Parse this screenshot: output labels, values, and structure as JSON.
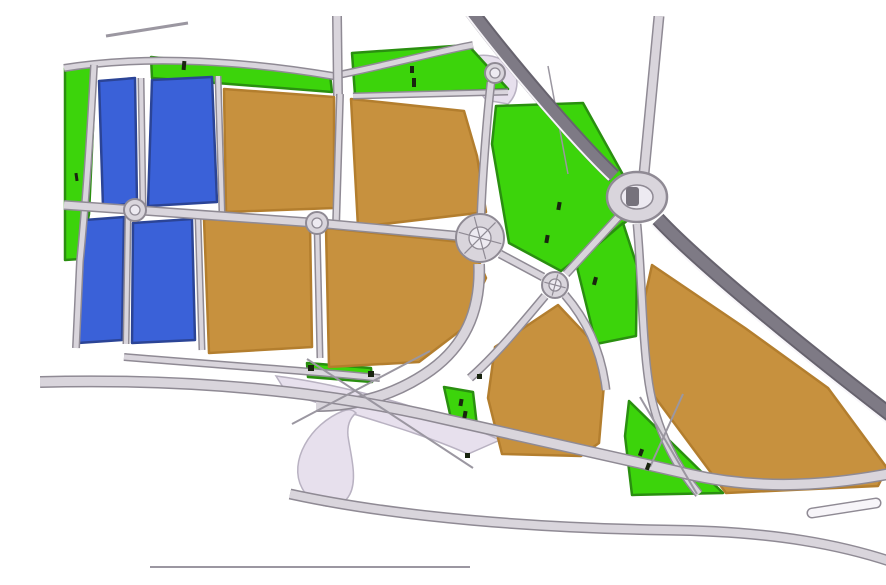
{
  "map": {
    "width": 886,
    "height": 553,
    "background": "#ffffff",
    "palette": {
      "road_fill": "#d9d5dc",
      "road_casing": "#8f8a94",
      "road_thin": "#9b97a1",
      "highway_fill": "#7e7a85",
      "highway_casing": "#67636e",
      "zone_fill": "#e7e0ed",
      "zone_edge": "#b9b2c2",
      "green_fill": "#3cd40b",
      "green_edge": "#2a8f10",
      "blue_fill": "#3a61d8",
      "blue_edge": "#2b4496",
      "tan_fill": "#c7913e",
      "tan_edge": "#b37e2e",
      "island_fill": "#edeaf1",
      "mark": "#19240f",
      "white_line": "#f7f5f9"
    },
    "zones": [
      {
        "name": "interchange-zone",
        "d": "M236,360 C300,368 390,392 460,424 L428,438 C370,412 300,396 246,376 Z"
      },
      {
        "name": "loop-ramp-teardrop",
        "d": "M303,395 C270,408 248,446 262,472 C272,492 300,498 310,478 C318,462 310,436 308,420 C307,410 310,402 316,397 C312,393 308,393 303,395 Z"
      },
      {
        "name": "north-interchange-zone",
        "d": "M430,42 C444,36 462,40 472,52 C480,62 478,78 468,88 L446,84 C436,72 430,56 430,42 Z"
      }
    ],
    "parcels": [
      {
        "name": "green-strip-west",
        "type": "green",
        "d": "M25,52 L56,47 L49,198 L40,243 L25,244 Z"
      },
      {
        "name": "green-strip-north-small",
        "type": "green",
        "d": "M111,41 L290,59 L292,76 L112,62 Z"
      },
      {
        "name": "green-strip-north-large",
        "type": "green",
        "d": "M312,37 L428,29 L468,73 L315,79 Z"
      },
      {
        "name": "green-parcel-central-north",
        "type": "green",
        "d": "M456,90 L543,87 L587,166 L592,201 L521,255 L469,227 L452,128 Z"
      },
      {
        "name": "green-parcel-central-east",
        "type": "green",
        "d": "M536,247 L583,207 L597,250 L596,320 L556,328 Z"
      },
      {
        "name": "green-strip-south-small",
        "type": "green",
        "d": "M267,347 L331,352 L332,366 L268,361 Z"
      },
      {
        "name": "green-strip-mid-small",
        "type": "green",
        "d": "M404,371 L433,376 L437,410 L412,407 Z"
      },
      {
        "name": "green-triangle-south",
        "type": "green",
        "d": "M589,385 L683,477 L592,479 L585,420 Z"
      },
      {
        "name": "green-triangle-corner",
        "type": "green",
        "d": "M848,492 L886,455 L886,494 Z"
      },
      {
        "name": "blue-parcel-nw",
        "type": "blue",
        "d": "M59,65 L95,62 L97,187 L63,191 Z"
      },
      {
        "name": "blue-parcel-north",
        "type": "blue",
        "d": "M112,64 L172,61 L177,186 L108,190 Z"
      },
      {
        "name": "blue-parcel-sw",
        "type": "blue",
        "d": "M45,204 L84,201 L82,324 L38,327 Z"
      },
      {
        "name": "blue-parcel-south",
        "type": "blue",
        "d": "M93,207 L152,203 L155,324 L92,327 Z"
      },
      {
        "name": "tan-parcel-a",
        "type": "tan",
        "d": "M184,73 L294,81 L294,192 L186,196 Z"
      },
      {
        "name": "tan-parcel-b",
        "type": "tan",
        "d": "M311,83 L424,95 L437,140 L446,196 L318,211 Z"
      },
      {
        "name": "tan-parcel-c",
        "type": "tan",
        "d": "M164,203 L270,209 L272,331 L169,337 Z"
      },
      {
        "name": "tan-parcel-d",
        "type": "tan",
        "d": "M286,212 L431,227 L446,262 L421,314 L379,346 L289,351 Z"
      },
      {
        "name": "tan-parcel-e",
        "type": "tan",
        "d": "M455,331 L518,289 L551,324 L564,368 L559,427 L541,440 L462,438 L448,382 Z"
      },
      {
        "name": "tan-parcel-f",
        "type": "tan",
        "d": "M612,249 L705,312 L788,372 L847,452 L838,470 L686,477 L609,373 L601,299 Z"
      }
    ],
    "roads": [
      {
        "name": "top-left-road-stub",
        "kind": "thin",
        "d": "M66,20 L148,7",
        "w": 3
      },
      {
        "name": "north-boundary-road",
        "kind": "local",
        "d": "M24,52 C110,38 210,46 293,60 C345,50 400,35 433,29",
        "w": 5
      },
      {
        "name": "green-strip-south-road",
        "kind": "local",
        "d": "M313,80 L468,76",
        "w": 4
      },
      {
        "name": "north-vertical-road",
        "kind": "local",
        "d": "M297,0 L298,80",
        "w": 7
      },
      {
        "name": "west-vertical-road",
        "kind": "local",
        "d": "M54,49 C49,140 44,205 40,245 L36,332",
        "w": 5
      },
      {
        "name": "blue-column-road-upper",
        "kind": "local",
        "d": "M101,62 L103,191",
        "w": 4
      },
      {
        "name": "blue-column-road-lower",
        "kind": "local",
        "d": "M88,200 L86,328",
        "w": 4
      },
      {
        "name": "blue-tan-divider-upper",
        "kind": "local",
        "d": "M178,60 L182,196",
        "w": 4
      },
      {
        "name": "blue-tan-divider-lower",
        "kind": "local",
        "d": "M158,201 L162,334",
        "w": 4
      },
      {
        "name": "tan-divider-vertical",
        "kind": "local",
        "d": "M300,78 L296,211",
        "w": 5
      },
      {
        "name": "tan-column-road",
        "kind": "local",
        "d": "M277,207 L280,342",
        "w": 4
      },
      {
        "name": "mid-horizontal-avenue",
        "kind": "local",
        "d": "M24,189 L95,194 L277,207 L440,222",
        "w": 7
      },
      {
        "name": "south-boundary-road",
        "kind": "local",
        "d": "M84,341 C180,349 270,355 340,362",
        "w": 5
      },
      {
        "name": "interchange-vertical-link",
        "kind": "local",
        "d": "M451,66 C446,110 442,170 441,198",
        "w": 6
      },
      {
        "name": "main-curve-from-center",
        "kind": "local",
        "d": "M439,248 C441,296 424,330 391,354 C356,379 316,390 276,390",
        "w": 9
      },
      {
        "name": "center-to-small-roundabout",
        "kind": "local",
        "d": "M460,238 L503,261",
        "w": 6
      },
      {
        "name": "small-roundabout-to-ellipse",
        "kind": "local",
        "d": "M526,258 L582,197",
        "w": 6
      },
      {
        "name": "small-roundabout-southeast-road",
        "kind": "local",
        "d": "M525,279 C550,308 562,340 566,374",
        "w": 6
      },
      {
        "name": "small-roundabout-southwest-road",
        "kind": "local",
        "d": "M505,280 C480,310 455,340 430,362",
        "w": 6
      },
      {
        "name": "ellipse-south-road",
        "kind": "local",
        "d": "M597,208 C602,260 602,322 609,368 C616,414 637,452 659,478",
        "w": 6
      },
      {
        "name": "north-road-to-ellipse",
        "kind": "local",
        "d": "M619,0 L604,158",
        "w": 8
      },
      {
        "name": "southwest-sweep-boulevard",
        "kind": "local",
        "d": "M0,366 C150,362 280,376 382,398 C500,424 570,440 648,458 C730,477 810,468 886,450",
        "w": 9
      },
      {
        "name": "south-parallel-road",
        "kind": "local",
        "d": "M250,478 C360,502 500,512 624,514 C730,515 806,528 872,553",
        "w": 8
      },
      {
        "name": "bottom-edge-line",
        "kind": "thin",
        "d": "M110,551 L430,551",
        "w": 2
      },
      {
        "name": "ramp-line-a",
        "kind": "thin",
        "d": "M267,343 L433,452",
        "w": 2
      },
      {
        "name": "ramp-line-b",
        "kind": "thin",
        "d": "M390,335 L252,408",
        "w": 2
      },
      {
        "name": "green-triangle-line-a",
        "kind": "thin",
        "d": "M600,381 L657,478",
        "w": 2
      },
      {
        "name": "green-triangle-line-b",
        "kind": "thin",
        "d": "M643,378 L610,451",
        "w": 2
      },
      {
        "name": "green-parcel-boundary-line",
        "kind": "thin",
        "d": "M508,50 L528,158",
        "w": 1.5
      },
      {
        "name": "corner-green-line",
        "kind": "thin",
        "d": "M852,488 L882,458",
        "w": 1.5
      },
      {
        "name": "main-diagonal-highway-north",
        "kind": "highway",
        "d": "M429,-8 C468,44 538,126 574,160",
        "w": 11
      },
      {
        "name": "main-diagonal-highway-south",
        "kind": "highway",
        "d": "M618,203 C660,248 770,338 886,426",
        "w": 11
      },
      {
        "name": "highway-edge-line-south",
        "kind": "white",
        "d": "M612,209 C654,254 764,344 880,432",
        "w": 2
      },
      {
        "name": "highway-edge-line-north",
        "kind": "white",
        "d": "M424,-4 C463,48 533,130 569,164",
        "w": 2
      }
    ],
    "slots": [
      {
        "name": "median-island",
        "d": "M772,497 L836,487",
        "w": 8
      }
    ],
    "roundabouts": [
      {
        "name": "interchange-circle",
        "cx": 455,
        "cy": 57,
        "r": 10,
        "ri": 5
      },
      {
        "name": "roundabout-west",
        "cx": 95,
        "cy": 194,
        "r": 11,
        "ri": 5
      },
      {
        "name": "roundabout-midwest",
        "cx": 277,
        "cy": 207,
        "r": 11,
        "ri": 5
      },
      {
        "name": "roundabout-center",
        "cx": 440,
        "cy": 222,
        "r": 24,
        "ri": 11,
        "spokes": 3
      },
      {
        "name": "roundabout-small-east",
        "cx": 515,
        "cy": 269,
        "r": 13,
        "ri": 6,
        "spokes": 2
      },
      {
        "name": "roundabout-main-ellipse",
        "cx": 597,
        "cy": 181,
        "rx": 30,
        "ry": 25,
        "rix": 16,
        "riy": 12,
        "blob": true
      }
    ],
    "marks": [
      {
        "x": 35,
        "y": 157,
        "w": 3,
        "h": 8,
        "rot": -8
      },
      {
        "x": 142,
        "y": 45,
        "w": 4,
        "h": 9,
        "rot": 5
      },
      {
        "x": 370,
        "y": 50,
        "w": 4,
        "h": 7,
        "rot": 0
      },
      {
        "x": 372,
        "y": 62,
        "w": 4,
        "h": 9,
        "rot": 0
      },
      {
        "x": 517,
        "y": 186,
        "w": 4,
        "h": 8,
        "rot": 10
      },
      {
        "x": 505,
        "y": 219,
        "w": 4,
        "h": 8,
        "rot": 10
      },
      {
        "x": 553,
        "y": 261,
        "w": 4,
        "h": 8,
        "rot": 15
      },
      {
        "x": 599,
        "y": 433,
        "w": 4,
        "h": 7,
        "rot": 20
      },
      {
        "x": 606,
        "y": 447,
        "w": 4,
        "h": 7,
        "rot": 20
      },
      {
        "x": 419,
        "y": 383,
        "w": 4,
        "h": 7,
        "rot": 10
      },
      {
        "x": 423,
        "y": 395,
        "w": 4,
        "h": 7,
        "rot": 10
      },
      {
        "x": 862,
        "y": 472,
        "w": 4,
        "h": 7,
        "rot": -30
      },
      {
        "x": 268,
        "y": 349,
        "w": 6,
        "h": 6,
        "rot": 0
      },
      {
        "x": 328,
        "y": 355,
        "w": 6,
        "h": 6,
        "rot": 0
      },
      {
        "x": 437,
        "y": 358,
        "w": 5,
        "h": 5,
        "rot": 0
      },
      {
        "x": 425,
        "y": 437,
        "w": 5,
        "h": 5,
        "rot": 0
      }
    ]
  }
}
